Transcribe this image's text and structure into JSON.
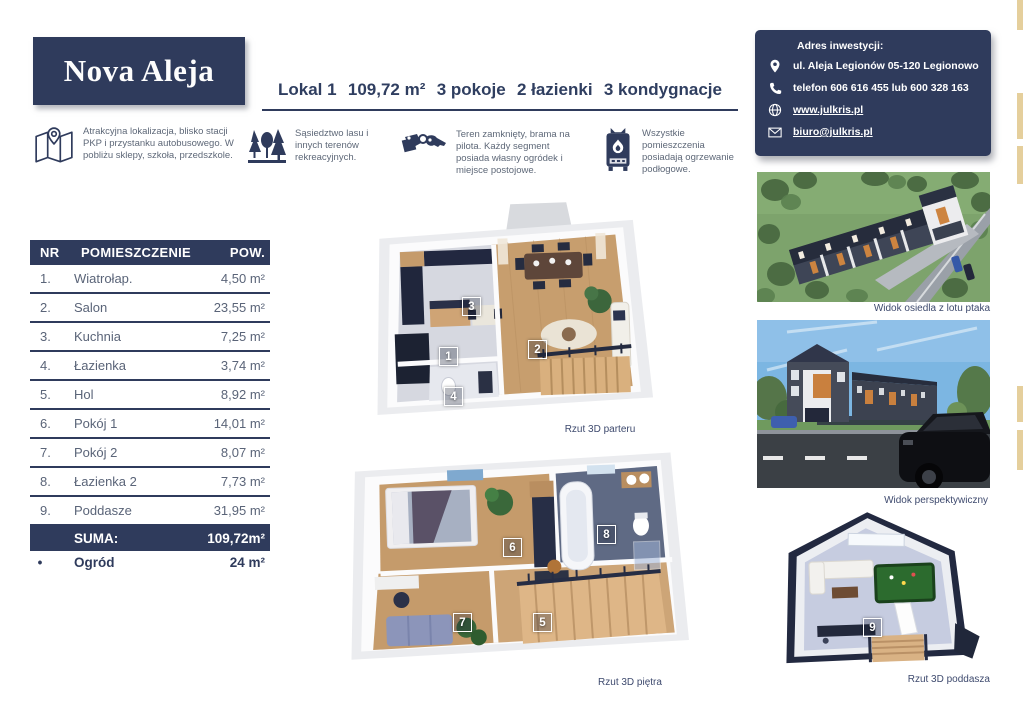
{
  "brand": {
    "name": "Nova Aleja"
  },
  "header": {
    "parts": [
      "Lokal 1",
      "109,72 m²",
      "3 pokoje",
      "2 łazienki",
      "3 kondygnacje"
    ]
  },
  "contact": {
    "heading": "Adres inwestycji:",
    "address": "ul. Aleja Legionów 05-120 Legionowo",
    "phone": "telefon 606 616 455 lub 600 328 163",
    "website": "www.julkris.pl",
    "email": "biuro@julkris.pl"
  },
  "features": [
    {
      "icon": "map-icon",
      "text": "Atrakcyjna lokalizacja, blisko stacji PKP i przystanku autobusowego. W pobliżu sklepy, szkoła, przedszkole."
    },
    {
      "icon": "trees-icon",
      "text": "Sąsiedztwo lasu i innych terenów rekreacyjnych."
    },
    {
      "icon": "keys-icon",
      "text": "Teren zamknięty, brama na pilota. Każdy segment posiada własny ogródek i miejsce postojowe."
    },
    {
      "icon": "boiler-icon",
      "text": "Wszystkie pomieszczenia posiadają ogrzewanie podłogowe."
    }
  ],
  "rooms_table": {
    "headers": [
      "NR",
      "POMIESZCZENIE",
      "POW."
    ],
    "rows": [
      {
        "nr": "1.",
        "name": "Wiatrołap.",
        "area": "4,50 m²"
      },
      {
        "nr": "2.",
        "name": "Salon",
        "area": "23,55 m²"
      },
      {
        "nr": "3.",
        "name": "Kuchnia",
        "area": "7,25 m²"
      },
      {
        "nr": "4.",
        "name": "Łazienka",
        "area": "3,74 m²"
      },
      {
        "nr": "5.",
        "name": "Hol",
        "area": "8,92 m²"
      },
      {
        "nr": "6.",
        "name": "Pokój 1",
        "area": "14,01 m²"
      },
      {
        "nr": "7.",
        "name": "Pokój 2",
        "area": "8,07 m²"
      },
      {
        "nr": "8.",
        "name": "Łazienka 2",
        "area": "7,73 m²"
      },
      {
        "nr": "9.",
        "name": "Poddasze",
        "area": "31,95 m²"
      }
    ],
    "sum_label": "SUMA:",
    "sum_value": "109,72m²",
    "garden_bullet": "•",
    "garden_label": "Ogród",
    "garden_value": "24 m²"
  },
  "plans": {
    "ground": {
      "caption": "Rzut 3D parteru",
      "labels": [
        "1",
        "2",
        "3",
        "4"
      ]
    },
    "first": {
      "caption": "Rzut 3D piętra",
      "labels": [
        "5",
        "6",
        "7",
        "8"
      ]
    },
    "attic": {
      "caption": "Rzut 3D poddasza",
      "labels": [
        "9"
      ]
    }
  },
  "photos": {
    "aerial": {
      "caption": "Widok osiedla z lotu ptaka"
    },
    "perspective": {
      "caption": "Widok perspektywiczny"
    }
  },
  "colors": {
    "navy": "#2f3b5c",
    "gold": "#e5cf9c"
  }
}
